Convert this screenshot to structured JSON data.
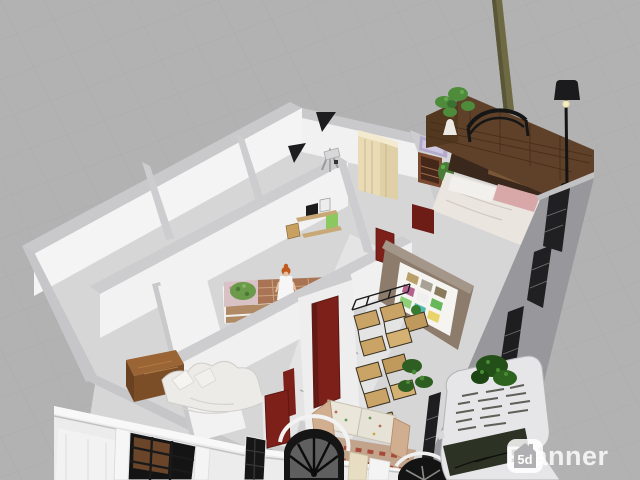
{
  "app": {
    "name": "Planner 5d",
    "view_mode": "3D floor plan render"
  },
  "watermark": {
    "brand": "Planner",
    "badge": "5d"
  },
  "canvas": {
    "width": 640,
    "height": 480,
    "background": "#b2b2b3",
    "grid_line": "#a9a9ab"
  },
  "palette": {
    "wall_white": "#f3f3f3",
    "wall_top_gray": "#c9c9cb",
    "floor_gray": "#d6d6d6",
    "marble_floor": "#e4e4e4",
    "door_maroon": "#7c2019",
    "fence_wood": "#5f4129",
    "desk_wood": "#9a6434",
    "chair_wood": "#c9a466",
    "wardrobe_cream": "#eadbb6",
    "feature_wall_taupe": "#8d7c6c",
    "lamp_black": "#1b1b1d",
    "plant_green": "#4e8c3c",
    "car_body": "#e6e6e8",
    "exterior_wall": "#98989c"
  },
  "scene_objects": [
    {
      "name": "perspective-grid-floor"
    },
    {
      "name": "house-floor"
    },
    {
      "name": "marble-hallway"
    },
    {
      "name": "staircase"
    },
    {
      "name": "back-wall"
    },
    {
      "name": "interior-walls"
    },
    {
      "name": "feature-wall-with-color-swatch-poster"
    },
    {
      "name": "kids-bed"
    },
    {
      "name": "child-figure"
    },
    {
      "name": "wall-shelves"
    },
    {
      "name": "cream-wardrobe"
    },
    {
      "name": "drafting-easel"
    },
    {
      "name": "purple-wall-art"
    },
    {
      "name": "bookshelf"
    },
    {
      "name": "floating-shelf"
    },
    {
      "name": "master-bed"
    },
    {
      "name": "wood-plank-headboard"
    },
    {
      "name": "metal-bed-frame"
    },
    {
      "name": "bonsai-plant"
    },
    {
      "name": "decorative-bust"
    },
    {
      "name": "tree-trunk"
    },
    {
      "name": "floor-lamp"
    },
    {
      "name": "right-exterior-wall-with-windows"
    },
    {
      "name": "maroon-doors",
      "count": 5
    },
    {
      "name": "wooden-desk"
    },
    {
      "name": "white-daybed"
    },
    {
      "name": "stacked-wooden-chairs"
    },
    {
      "name": "fern-plant"
    },
    {
      "name": "floral-sofa"
    },
    {
      "name": "checkered-rug"
    },
    {
      "name": "classical-facade-with-black-windows"
    },
    {
      "name": "arched-fanlight-window"
    },
    {
      "name": "white-car"
    },
    {
      "name": "green-bush"
    }
  ]
}
